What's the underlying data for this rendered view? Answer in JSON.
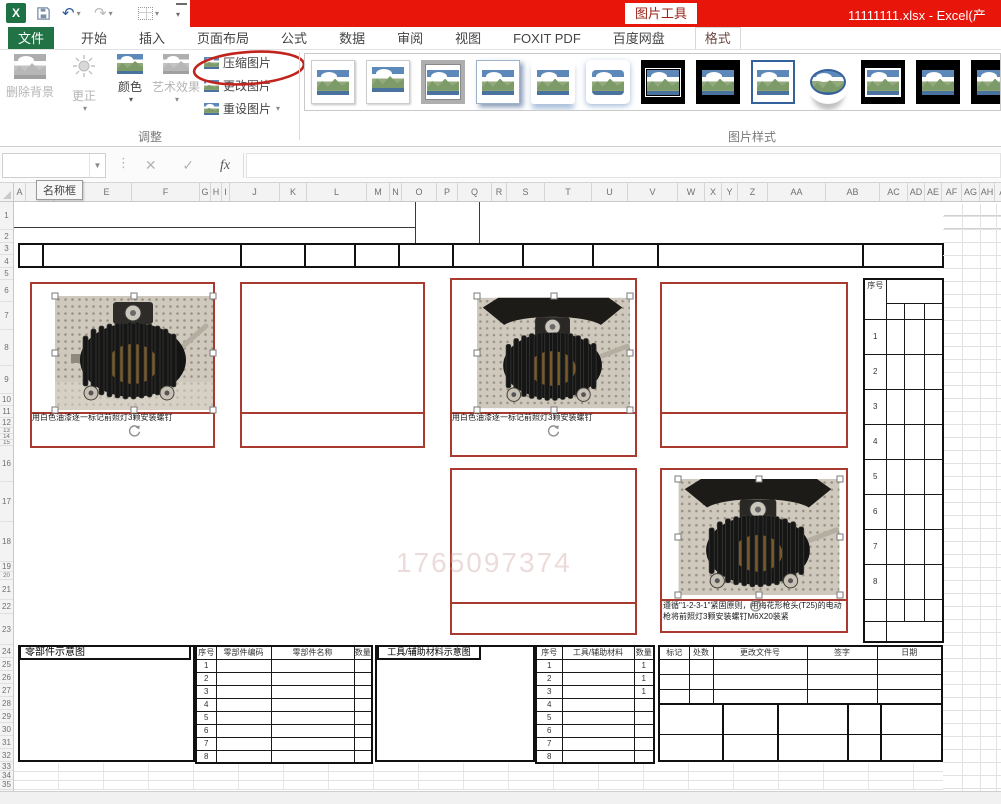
{
  "titlebar": {
    "contextual_label": "图片工具",
    "window_title": "11111111.xlsx -  Excel(产"
  },
  "tabs": {
    "file": "文件",
    "items": [
      "开始",
      "插入",
      "页面布局",
      "公式",
      "数据",
      "审阅",
      "视图",
      "FOXIT PDF",
      "百度网盘"
    ],
    "contextual": "格式"
  },
  "ribbon": {
    "adjust": {
      "group_label": "调整",
      "remove_bg": "删除背景",
      "corrections": "更正",
      "color": "颜色",
      "artistic": "艺术效果",
      "compress": "压缩图片",
      "change": "更改图片",
      "reset": "重设图片"
    },
    "styles": {
      "group_label": "图片样式",
      "items": [
        "simple-frame-white",
        "beveled-matte-white",
        "metal-frame",
        "drop-shadow-rectangle",
        "reflected-rounded-rectangle",
        "soft-edge-rectangle",
        "double-frame-black",
        "thick-frame-black",
        "simple-frame-blue",
        "bevel-oval-black",
        "compound-frame-black",
        "moderate-frame-black",
        "partial-style"
      ]
    }
  },
  "formula_bar": {
    "name_box": "",
    "cancel": "✕",
    "enter": "✓",
    "fx": "fx",
    "tooltip": "名称框"
  },
  "grid": {
    "columns": [
      [
        "A",
        12
      ],
      [
        "B",
        28
      ],
      [
        "D",
        28
      ],
      [
        "E",
        50
      ],
      [
        "F",
        68
      ],
      [
        "G",
        11
      ],
      [
        "H",
        11
      ],
      [
        "I",
        8
      ],
      [
        "J",
        50
      ],
      [
        "K",
        27
      ],
      [
        "L",
        60
      ],
      [
        "M",
        23
      ],
      [
        "N",
        12
      ],
      [
        "O",
        35
      ],
      [
        "P",
        21
      ],
      [
        "Q",
        34
      ],
      [
        "R",
        15
      ],
      [
        "S",
        38
      ],
      [
        "T",
        47
      ],
      [
        "U",
        36
      ],
      [
        "V",
        50
      ],
      [
        "W",
        27
      ],
      [
        "X",
        17
      ],
      [
        "Y",
        16
      ],
      [
        "Z",
        30
      ],
      [
        "AA",
        58
      ],
      [
        "AB",
        54
      ],
      [
        "AC",
        28
      ],
      [
        "AD",
        17
      ],
      [
        "AE",
        17
      ],
      [
        "AF",
        20
      ],
      [
        "AG",
        18
      ],
      [
        "AH",
        15
      ],
      [
        "AI",
        18
      ],
      [
        "AJ",
        27
      ]
    ],
    "rows": [
      [
        1,
        28
      ],
      [
        2,
        13
      ],
      [
        3,
        12
      ],
      [
        4,
        13
      ],
      [
        5,
        12
      ],
      [
        6,
        22
      ],
      [
        7,
        28
      ],
      [
        8,
        36
      ],
      [
        9,
        28
      ],
      [
        10,
        12
      ],
      [
        11,
        12
      ],
      [
        12,
        10
      ],
      [
        13,
        6
      ],
      [
        14,
        6
      ],
      [
        15,
        6
      ],
      [
        16,
        36
      ],
      [
        17,
        40
      ],
      [
        18,
        40
      ],
      [
        19,
        10
      ],
      [
        20,
        8
      ],
      [
        21,
        20
      ],
      [
        22,
        14
      ],
      [
        23,
        31
      ],
      [
        24,
        13
      ],
      [
        25,
        13
      ],
      [
        26,
        13
      ],
      [
        27,
        13
      ],
      [
        28,
        13
      ],
      [
        29,
        13
      ],
      [
        30,
        13
      ],
      [
        31,
        13
      ],
      [
        32,
        13
      ],
      [
        33,
        9
      ],
      [
        34,
        9
      ],
      [
        35,
        10
      ]
    ]
  },
  "sheet": {
    "captions": {
      "photo1": "用白色油漆逐一标记前照灯3颗安装螺钉",
      "photo2": "用白色油漆逐一标记前照灯3颗安装螺钉",
      "photo3_line1": "遵循\"1-2-3-1\"紧固原则，用梅花形枪头(T25)的电动枪将前照灯3颗",
      "photo3_line2": "安装螺钉M6X20装紧"
    },
    "watermark": "1765097374",
    "serial_table": {
      "header": "序号",
      "rows": [
        "1",
        "2",
        "3",
        "4",
        "5",
        "6",
        "7",
        "8"
      ]
    },
    "bottom": {
      "parts_diagram_label": "零部件示意图",
      "tools_diagram_label": "工具/辅助材料示意图",
      "parts_table": {
        "headers": [
          "序号",
          "零部件编码",
          "零部件名称",
          "数量"
        ],
        "rows": [
          [
            "1",
            "",
            "",
            ""
          ],
          [
            "2",
            "",
            "",
            ""
          ],
          [
            "3",
            "",
            "",
            ""
          ],
          [
            "4",
            "",
            "",
            ""
          ],
          [
            "5",
            "",
            "",
            ""
          ],
          [
            "6",
            "",
            "",
            ""
          ],
          [
            "7",
            "",
            "",
            ""
          ],
          [
            "8",
            "",
            "",
            ""
          ]
        ]
      },
      "tools_table": {
        "headers": [
          "序号",
          "工具/辅助材料",
          "数量"
        ],
        "rows": [
          [
            "1",
            "",
            "1"
          ],
          [
            "2",
            "",
            "1"
          ],
          [
            "3",
            "",
            "1"
          ],
          [
            "4",
            "",
            ""
          ],
          [
            "5",
            "",
            ""
          ],
          [
            "6",
            "",
            ""
          ],
          [
            "7",
            "",
            ""
          ],
          [
            "8",
            "",
            ""
          ]
        ]
      },
      "revision_headers": [
        "标记",
        "处数",
        "更改文件号",
        "签字",
        "日期"
      ]
    }
  },
  "colors": {
    "accent_red": "#e8150b",
    "annotation_red": "#c0241c",
    "cell_border_red": "#a93a30",
    "excel_green": "#217346"
  }
}
